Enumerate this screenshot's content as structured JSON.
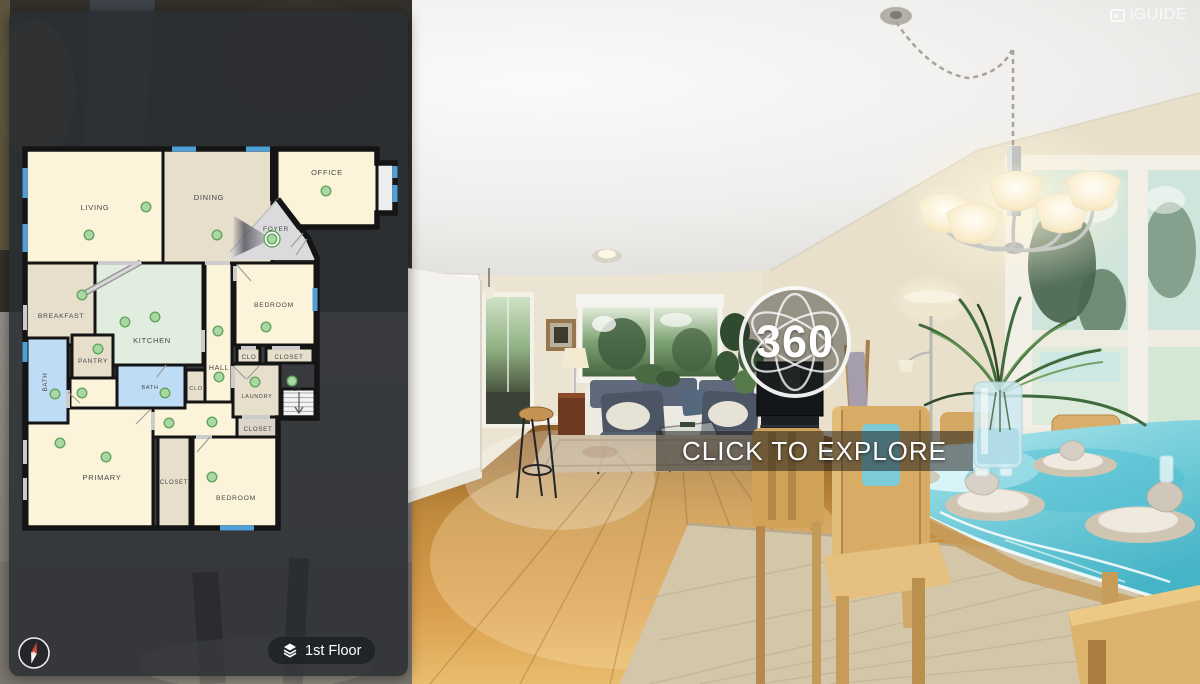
{
  "branding": {
    "logo": "iGUIDE"
  },
  "viewer": {
    "badge": "360",
    "cta": "CLICK TO EXPLORE"
  },
  "controls": {
    "floor_label": "1st Floor"
  },
  "colors": {
    "wall": "#141414",
    "window": "#4da0d8",
    "door": "#cccccc",
    "door_leaf": "#9a9a9a",
    "marker_fill": "#a9d8a4",
    "marker_stroke": "#64a55e",
    "room_cream": "#fcf4da",
    "room_tan": "#e7decc",
    "room_mint": "#e1eedf",
    "room_blue": "#bedcf6",
    "room_gray": "#dbdbde",
    "panel_bg": "rgba(43,47,51,0.88)",
    "accent_glass": "#7fd2de"
  },
  "floorplan": {
    "floor_name": "1st Floor",
    "labels": [
      {
        "text": "LIVING",
        "x": 95,
        "y": 210,
        "s": 7.5
      },
      {
        "text": "DINING",
        "x": 209,
        "y": 200,
        "s": 7.5
      },
      {
        "text": "OFFICE",
        "x": 327,
        "y": 175,
        "s": 7.5
      },
      {
        "text": "FOYER",
        "x": 276,
        "y": 231,
        "s": 6.5
      },
      {
        "text": "BREAKFAST",
        "x": 61,
        "y": 318,
        "s": 6.8
      },
      {
        "text": "KITCHEN",
        "x": 152,
        "y": 343,
        "s": 7.5
      },
      {
        "text": "BEDROOM",
        "x": 274,
        "y": 307,
        "s": 6.8
      },
      {
        "text": "PANTRY",
        "x": 93,
        "y": 363,
        "s": 6.5
      },
      {
        "text": "BATH",
        "x": 47,
        "y": 382,
        "s": 6.2,
        "r": -90
      },
      {
        "text": "BATH",
        "x": 150,
        "y": 389,
        "s": 5.5
      },
      {
        "text": "HALL",
        "x": 219,
        "y": 370,
        "s": 7
      },
      {
        "text": "CLO",
        "x": 196,
        "y": 390,
        "s": 5.5
      },
      {
        "text": "CLO",
        "x": 249,
        "y": 359,
        "s": 6.2
      },
      {
        "text": "CLOSET",
        "x": 289,
        "y": 359,
        "s": 6.2
      },
      {
        "text": "LAUNDRY",
        "x": 257,
        "y": 398,
        "s": 5.5
      },
      {
        "text": "UP",
        "x": 297,
        "y": 391,
        "s": 4.5
      },
      {
        "text": "CLOSET",
        "x": 258,
        "y": 431,
        "s": 6.2
      },
      {
        "text": "PRIMARY",
        "x": 102,
        "y": 480,
        "s": 7.5
      },
      {
        "text": "CLOSET",
        "x": 174,
        "y": 484,
        "s": 6
      },
      {
        "text": "BEDROOM",
        "x": 236,
        "y": 500,
        "s": 6.8
      }
    ],
    "markers": [
      {
        "x": 146,
        "y": 207
      },
      {
        "x": 89,
        "y": 235
      },
      {
        "x": 217,
        "y": 235
      },
      {
        "x": 326,
        "y": 191
      },
      {
        "x": 272,
        "y": 239,
        "current": true
      },
      {
        "x": 82,
        "y": 295
      },
      {
        "x": 125,
        "y": 322
      },
      {
        "x": 155,
        "y": 317
      },
      {
        "x": 98,
        "y": 349
      },
      {
        "x": 55,
        "y": 394
      },
      {
        "x": 82,
        "y": 393
      },
      {
        "x": 165,
        "y": 393
      },
      {
        "x": 218,
        "y": 331
      },
      {
        "x": 219,
        "y": 377
      },
      {
        "x": 266,
        "y": 327
      },
      {
        "x": 255,
        "y": 382
      },
      {
        "x": 292,
        "y": 381
      },
      {
        "x": 169,
        "y": 423
      },
      {
        "x": 212,
        "y": 422
      },
      {
        "x": 60,
        "y": 443
      },
      {
        "x": 106,
        "y": 457
      },
      {
        "x": 212,
        "y": 477
      }
    ],
    "windows": [
      [
        172,
        149,
        196,
        149
      ],
      [
        246,
        149,
        270,
        149
      ],
      [
        25,
        168,
        25,
        198
      ],
      [
        25,
        224,
        25,
        252
      ],
      [
        25,
        342,
        25,
        362
      ],
      [
        395,
        166,
        395,
        178
      ],
      [
        395,
        185,
        395,
        202
      ],
      [
        315,
        288,
        315,
        311
      ],
      [
        220,
        528,
        254,
        528
      ]
    ],
    "doors": [
      [
        25,
        305,
        25,
        330
      ],
      [
        25,
        440,
        25,
        464
      ],
      [
        25,
        478,
        25,
        500
      ],
      [
        98,
        263,
        138,
        263
      ],
      [
        205,
        263,
        230,
        263
      ],
      [
        235,
        266,
        235,
        281
      ],
      [
        203,
        330,
        203,
        352
      ],
      [
        153,
        412,
        153,
        430
      ],
      [
        196,
        437,
        212,
        437
      ],
      [
        233,
        366,
        233,
        388
      ],
      [
        242,
        417,
        270,
        417
      ],
      [
        241,
        348,
        256,
        348
      ],
      [
        272,
        348,
        300,
        348
      ],
      [
        68,
        390,
        68,
        408
      ]
    ],
    "leaves": [
      [
        237,
        265,
        251,
        281
      ],
      [
        150,
        410,
        136,
        424
      ],
      [
        210,
        437,
        197,
        452
      ],
      [
        233,
        366,
        246,
        379
      ],
      [
        259,
        366,
        247,
        379
      ],
      [
        303,
        233,
        291,
        247
      ],
      [
        68,
        392,
        80,
        403
      ],
      [
        166,
        365,
        157,
        377
      ],
      [
        296,
        255,
        307,
        239
      ]
    ]
  }
}
